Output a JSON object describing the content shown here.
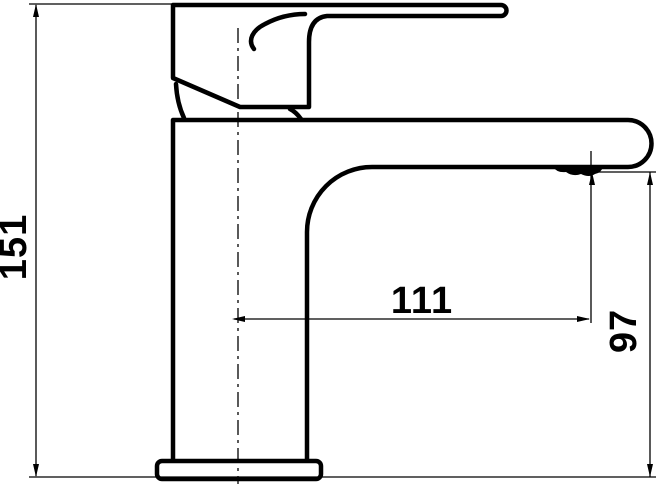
{
  "drawing": {
    "title": "Basin mixer tap — side view dimension drawing",
    "background_color": "#ffffff",
    "line_color": "#000000",
    "dimensions": {
      "overall_height": "151",
      "spout_reach": "111",
      "spout_outlet_height": "97"
    }
  }
}
